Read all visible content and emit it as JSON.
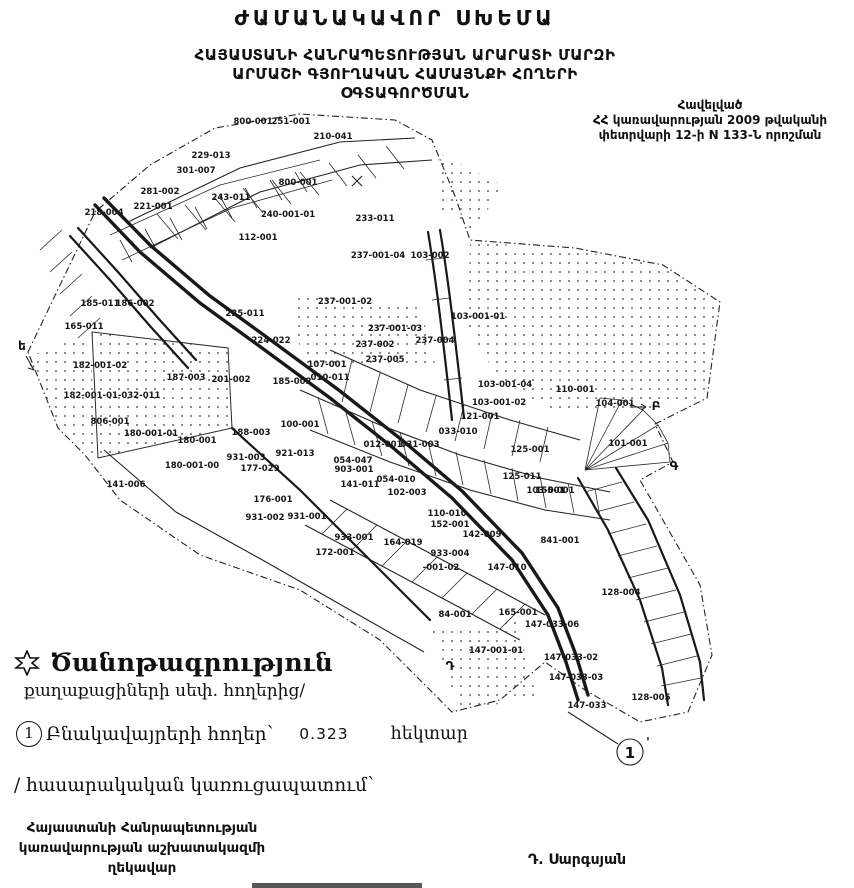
{
  "title": "ԺԱՄԱՆԱԿԱՎՈՐ ՍԽԵՄԱ",
  "subtitle": {
    "l1": "ՀԱՅԱՍՏԱՆԻ ՀԱՆՐԱՊԵՏՈՒԹՅԱՆ ԱՐԱՐԱՏԻ ՄԱՐԶԻ",
    "l2": "ԱՐՄԱՇԻ  ԳՅՈՒՂԱԿԱՆ ՀԱՄԱՅՆՔԻ ՀՈՂԵՐԻ",
    "l3": "ՕԳՏԱԳՈՐԾՄԱՆ"
  },
  "annotation": {
    "l1": "Հավելված",
    "l2": "ՀՀ կառավարության 2009 թվականի",
    "l3": "փետրվարի 12-ի N 133-Ն որոշման"
  },
  "legend": {
    "star_icon": "six-pointed-star",
    "title": "Ծանոթագրություն",
    "subtitle": "քաղաքացիների սեփ. հողերից/",
    "item_number": "1",
    "item_label": "Բնակավայրերի հողեր՝",
    "item_value": "0.323",
    "item_unit": "հեկտար",
    "footnote": "/ հասարակական կառուցապատում՝"
  },
  "footer": {
    "l1": "Հայաստանի Հանրապետության",
    "l2": "կառավարության աշխատակազմի",
    "l3": "ղեկավար",
    "signature": "Դ. Սարգսյան"
  },
  "colors": {
    "ink": "#111111",
    "paper": "#ffffff"
  },
  "map": {
    "pointer": {
      "label": "1",
      "tick": "'"
    },
    "letters": [
      {
        "t": "ե",
        "x": 22,
        "y": 350
      },
      {
        "t": "Բ",
        "x": 656,
        "y": 410
      },
      {
        "t": "Գ",
        "x": 674,
        "y": 470
      },
      {
        "t": "Դ",
        "x": 450,
        "y": 670
      }
    ],
    "labels": [
      {
        "t": "800-001",
        "x": 253,
        "y": 124
      },
      {
        "t": "251-001",
        "x": 291,
        "y": 124
      },
      {
        "t": "210-041",
        "x": 333,
        "y": 139
      },
      {
        "t": "229-013",
        "x": 211,
        "y": 158
      },
      {
        "t": "301-007",
        "x": 196,
        "y": 173
      },
      {
        "t": "800-001",
        "x": 298,
        "y": 185
      },
      {
        "t": "281-002",
        "x": 160,
        "y": 194
      },
      {
        "t": "221-001",
        "x": 153,
        "y": 209
      },
      {
        "t": "243-011",
        "x": 231,
        "y": 200
      },
      {
        "t": "218-004",
        "x": 104,
        "y": 215
      },
      {
        "t": "240-001-01",
        "x": 288,
        "y": 217
      },
      {
        "t": "112-001",
        "x": 258,
        "y": 240
      },
      {
        "t": "233-011",
        "x": 375,
        "y": 221
      },
      {
        "t": "237-001-04",
        "x": 378,
        "y": 258
      },
      {
        "t": "103-002",
        "x": 430,
        "y": 258
      },
      {
        "t": "237-001-02",
        "x": 345,
        "y": 304
      },
      {
        "t": "103-001-01",
        "x": 478,
        "y": 319
      },
      {
        "t": "237-001-03",
        "x": 395,
        "y": 331
      },
      {
        "t": "237-002",
        "x": 375,
        "y": 347
      },
      {
        "t": "237-004",
        "x": 435,
        "y": 343
      },
      {
        "t": "237-005",
        "x": 385,
        "y": 362
      },
      {
        "t": "103-001-04",
        "x": 505,
        "y": 387
      },
      {
        "t": "103-001-02",
        "x": 499,
        "y": 405
      },
      {
        "t": "121-001",
        "x": 480,
        "y": 419
      },
      {
        "t": "110-001",
        "x": 575,
        "y": 392
      },
      {
        "t": "104-001",
        "x": 615,
        "y": 406
      },
      {
        "t": "101-001",
        "x": 628,
        "y": 446
      },
      {
        "t": "185-011",
        "x": 100,
        "y": 306
      },
      {
        "t": "186-002",
        "x": 135,
        "y": 306
      },
      {
        "t": "165-011",
        "x": 84,
        "y": 329
      },
      {
        "t": "235-011",
        "x": 245,
        "y": 316
      },
      {
        "t": "224-022",
        "x": 271,
        "y": 343
      },
      {
        "t": "182-001-02",
        "x": 100,
        "y": 368
      },
      {
        "t": "187-003",
        "x": 186,
        "y": 380
      },
      {
        "t": "201-002",
        "x": 231,
        "y": 382
      },
      {
        "t": "185-002",
        "x": 292,
        "y": 384
      },
      {
        "t": "107-001",
        "x": 327,
        "y": 367
      },
      {
        "t": "010-011",
        "x": 330,
        "y": 380
      },
      {
        "t": "182-001-01-032-011",
        "x": 112,
        "y": 398
      },
      {
        "t": "806-001",
        "x": 110,
        "y": 424
      },
      {
        "t": "180-001-01",
        "x": 151,
        "y": 436
      },
      {
        "t": "180-001",
        "x": 197,
        "y": 443
      },
      {
        "t": "188-003",
        "x": 251,
        "y": 435
      },
      {
        "t": "100-001",
        "x": 300,
        "y": 427
      },
      {
        "t": "180-001-00",
        "x": 192,
        "y": 468
      },
      {
        "t": "931-003",
        "x": 246,
        "y": 460
      },
      {
        "t": "921-013",
        "x": 295,
        "y": 456
      },
      {
        "t": "141-006",
        "x": 126,
        "y": 487
      },
      {
        "t": "177-029",
        "x": 260,
        "y": 471
      },
      {
        "t": "176-001",
        "x": 273,
        "y": 502
      },
      {
        "t": "931-002",
        "x": 265,
        "y": 520
      },
      {
        "t": "931-001",
        "x": 307,
        "y": 519
      },
      {
        "t": "933-001",
        "x": 354,
        "y": 540
      },
      {
        "t": "172-001",
        "x": 335,
        "y": 555
      },
      {
        "t": "054-047",
        "x": 353,
        "y": 463
      },
      {
        "t": "903-001",
        "x": 354,
        "y": 472
      },
      {
        "t": "054-010",
        "x": 396,
        "y": 482
      },
      {
        "t": "141-011",
        "x": 360,
        "y": 487
      },
      {
        "t": "102-003",
        "x": 407,
        "y": 495
      },
      {
        "t": "033-010",
        "x": 458,
        "y": 434
      },
      {
        "t": "012-001",
        "x": 383,
        "y": 447
      },
      {
        "t": "031-003",
        "x": 420,
        "y": 447
      },
      {
        "t": "125-001",
        "x": 530,
        "y": 452
      },
      {
        "t": "125-011",
        "x": 522,
        "y": 479
      },
      {
        "t": "103-001",
        "x": 546,
        "y": 493
      },
      {
        "t": "110-010",
        "x": 447,
        "y": 516
      },
      {
        "t": "152-001",
        "x": 450,
        "y": 527
      },
      {
        "t": "142-009",
        "x": 482,
        "y": 537
      },
      {
        "t": "164-019",
        "x": 403,
        "y": 545
      },
      {
        "t": "933-004",
        "x": 450,
        "y": 556
      },
      {
        "t": "-001-02",
        "x": 441,
        "y": 570
      },
      {
        "t": "84-001",
        "x": 455,
        "y": 617
      },
      {
        "t": "155-001",
        "x": 555,
        "y": 493
      },
      {
        "t": "841-001",
        "x": 560,
        "y": 543
      },
      {
        "t": "147-010",
        "x": 507,
        "y": 570
      },
      {
        "t": "128-004",
        "x": 621,
        "y": 595
      },
      {
        "t": "165-001",
        "x": 518,
        "y": 615
      },
      {
        "t": "147-033-06",
        "x": 552,
        "y": 627
      },
      {
        "t": "147-001-01",
        "x": 496,
        "y": 653
      },
      {
        "t": "147-033-02",
        "x": 571,
        "y": 660
      },
      {
        "t": "147-033-03",
        "x": 576,
        "y": 680
      },
      {
        "t": "147-033",
        "x": 587,
        "y": 708
      },
      {
        "t": "128-005",
        "x": 651,
        "y": 700
      }
    ]
  }
}
